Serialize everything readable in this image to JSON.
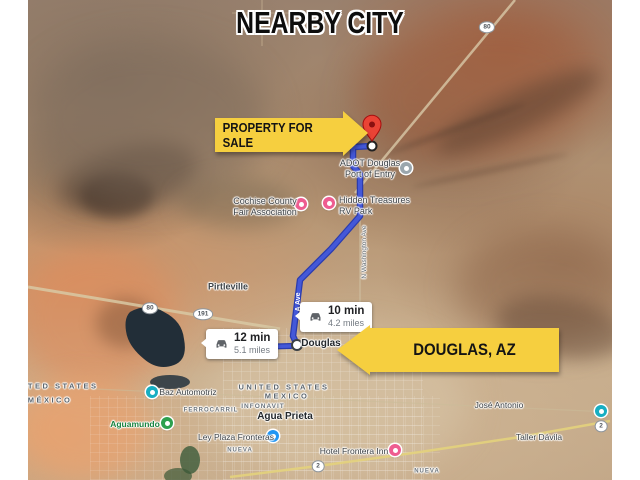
{
  "title": "NEARBY CITY",
  "callouts": {
    "property": "PROPERTY FOR SALE",
    "city": "DOUGLAS, AZ"
  },
  "route_bubbles": {
    "north": {
      "duration": "10 min",
      "distance": "4.2 miles"
    },
    "west": {
      "duration": "12 min",
      "distance": "5.1 miles"
    }
  },
  "places": {
    "port_line1": "ADOT Douglas",
    "port_line2": "Port of Entry",
    "fair_line1": "Cochise County",
    "fair_line2": "Fair Association",
    "rv_line1": "Hidden Treasures",
    "rv_line2": "RV Park",
    "douglas": "Douglas",
    "pirtleville": "Pirtleville",
    "agua_prieta": "Agua Prieta",
    "aguamundo": "Aguamundo",
    "baz_automotriz": "Baz Automotriz",
    "ley_plaza": "Ley Plaza Fronteras",
    "hotel_frontera": "Hotel Frontera Inn",
    "jose_antonio": "José Antonio",
    "taller_davila": "Taller Dávila",
    "infonavit": "INFONAVIT",
    "ferrocarril": "FERROCARRIL",
    "nueva": "NUEVA"
  },
  "border": {
    "us_left": "UNITED STATES",
    "mx_left": "MÉXICO",
    "us_center": "UNITED STATES",
    "mx_center": "MEXICO"
  },
  "roads": {
    "washington": "N Washington Ave",
    "a_ave": "A Ave",
    "shield_80": "80",
    "shield_191": "191",
    "shield_2": "2"
  },
  "colors": {
    "banner_yellow": "#f6cf3f",
    "route_blue": "#4458d8",
    "pin_red": "#ea4335"
  }
}
